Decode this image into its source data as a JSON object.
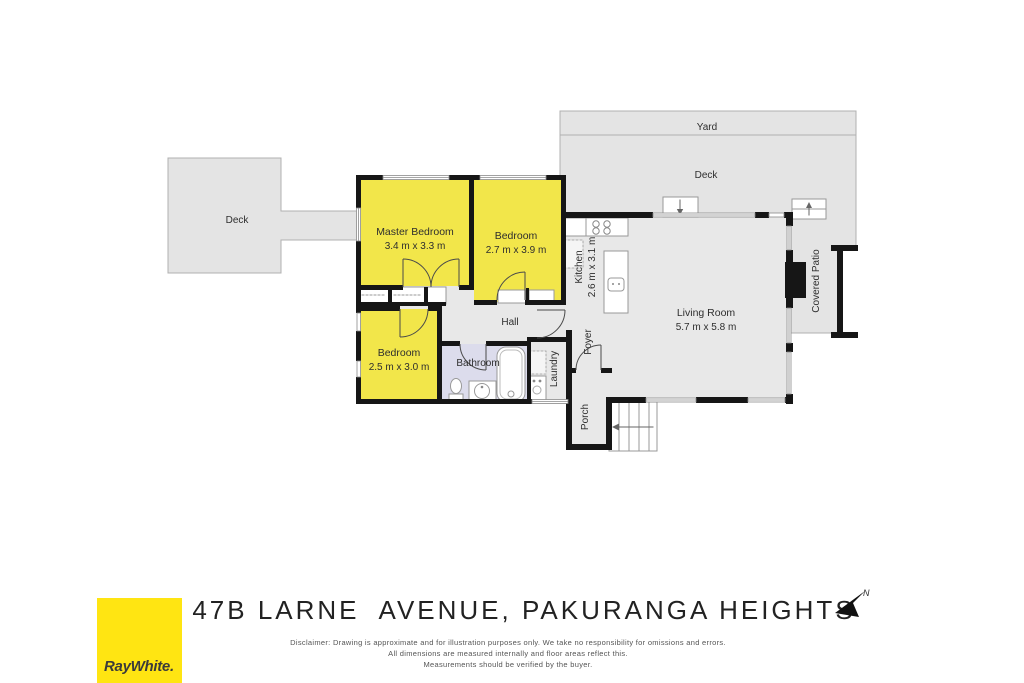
{
  "floorplan": {
    "rooms": {
      "yard": {
        "label": "Yard"
      },
      "deck_top": {
        "label": "Deck"
      },
      "deck_left": {
        "label": "Deck"
      },
      "master_bedroom": {
        "label": "Master Bedroom",
        "dimensions": "3.4 m x 3.3 m"
      },
      "bedroom2": {
        "label": "Bedroom",
        "dimensions": "2.7 m x 3.9 m"
      },
      "bedroom3": {
        "label": "Bedroom",
        "dimensions": "2.5 m x 3.0 m"
      },
      "hall": {
        "label": "Hall"
      },
      "bathroom": {
        "label": "Bathroom"
      },
      "laundry": {
        "label": "Laundry"
      },
      "foyer": {
        "label": "Foyer"
      },
      "porch": {
        "label": "Porch"
      },
      "kitchen": {
        "label": "Kitchen",
        "dimensions": "2.6 m x 3.1 m"
      },
      "living_room": {
        "label": "Living Room",
        "dimensions": "5.7 m x 5.8 m"
      },
      "covered_patio": {
        "label": "Covered Patio"
      }
    },
    "colors": {
      "bedroom_fill": "#F2E64A",
      "bathroom_fill": "#DCDCEC",
      "interior_fill": "#E8E8E8",
      "outdoor_fill": "#E4E4E4",
      "wall": "#161616"
    }
  },
  "footer": {
    "address": "47B LARNE  AVENUE, PAKURANGA HEIGHTS",
    "disclaimer_line1": "Disclaimer: Drawing is approximate and for illustration purposes only. We take no responsibility for omissions and errors.",
    "disclaimer_line2": "All dimensions are measured internally and floor areas reflect this.",
    "disclaimer_line3": "Measurements should be verified by the buyer.",
    "compass": {
      "label": "N"
    },
    "brand": {
      "name": "RayWhite.",
      "logo_color": "#FFE512"
    }
  }
}
